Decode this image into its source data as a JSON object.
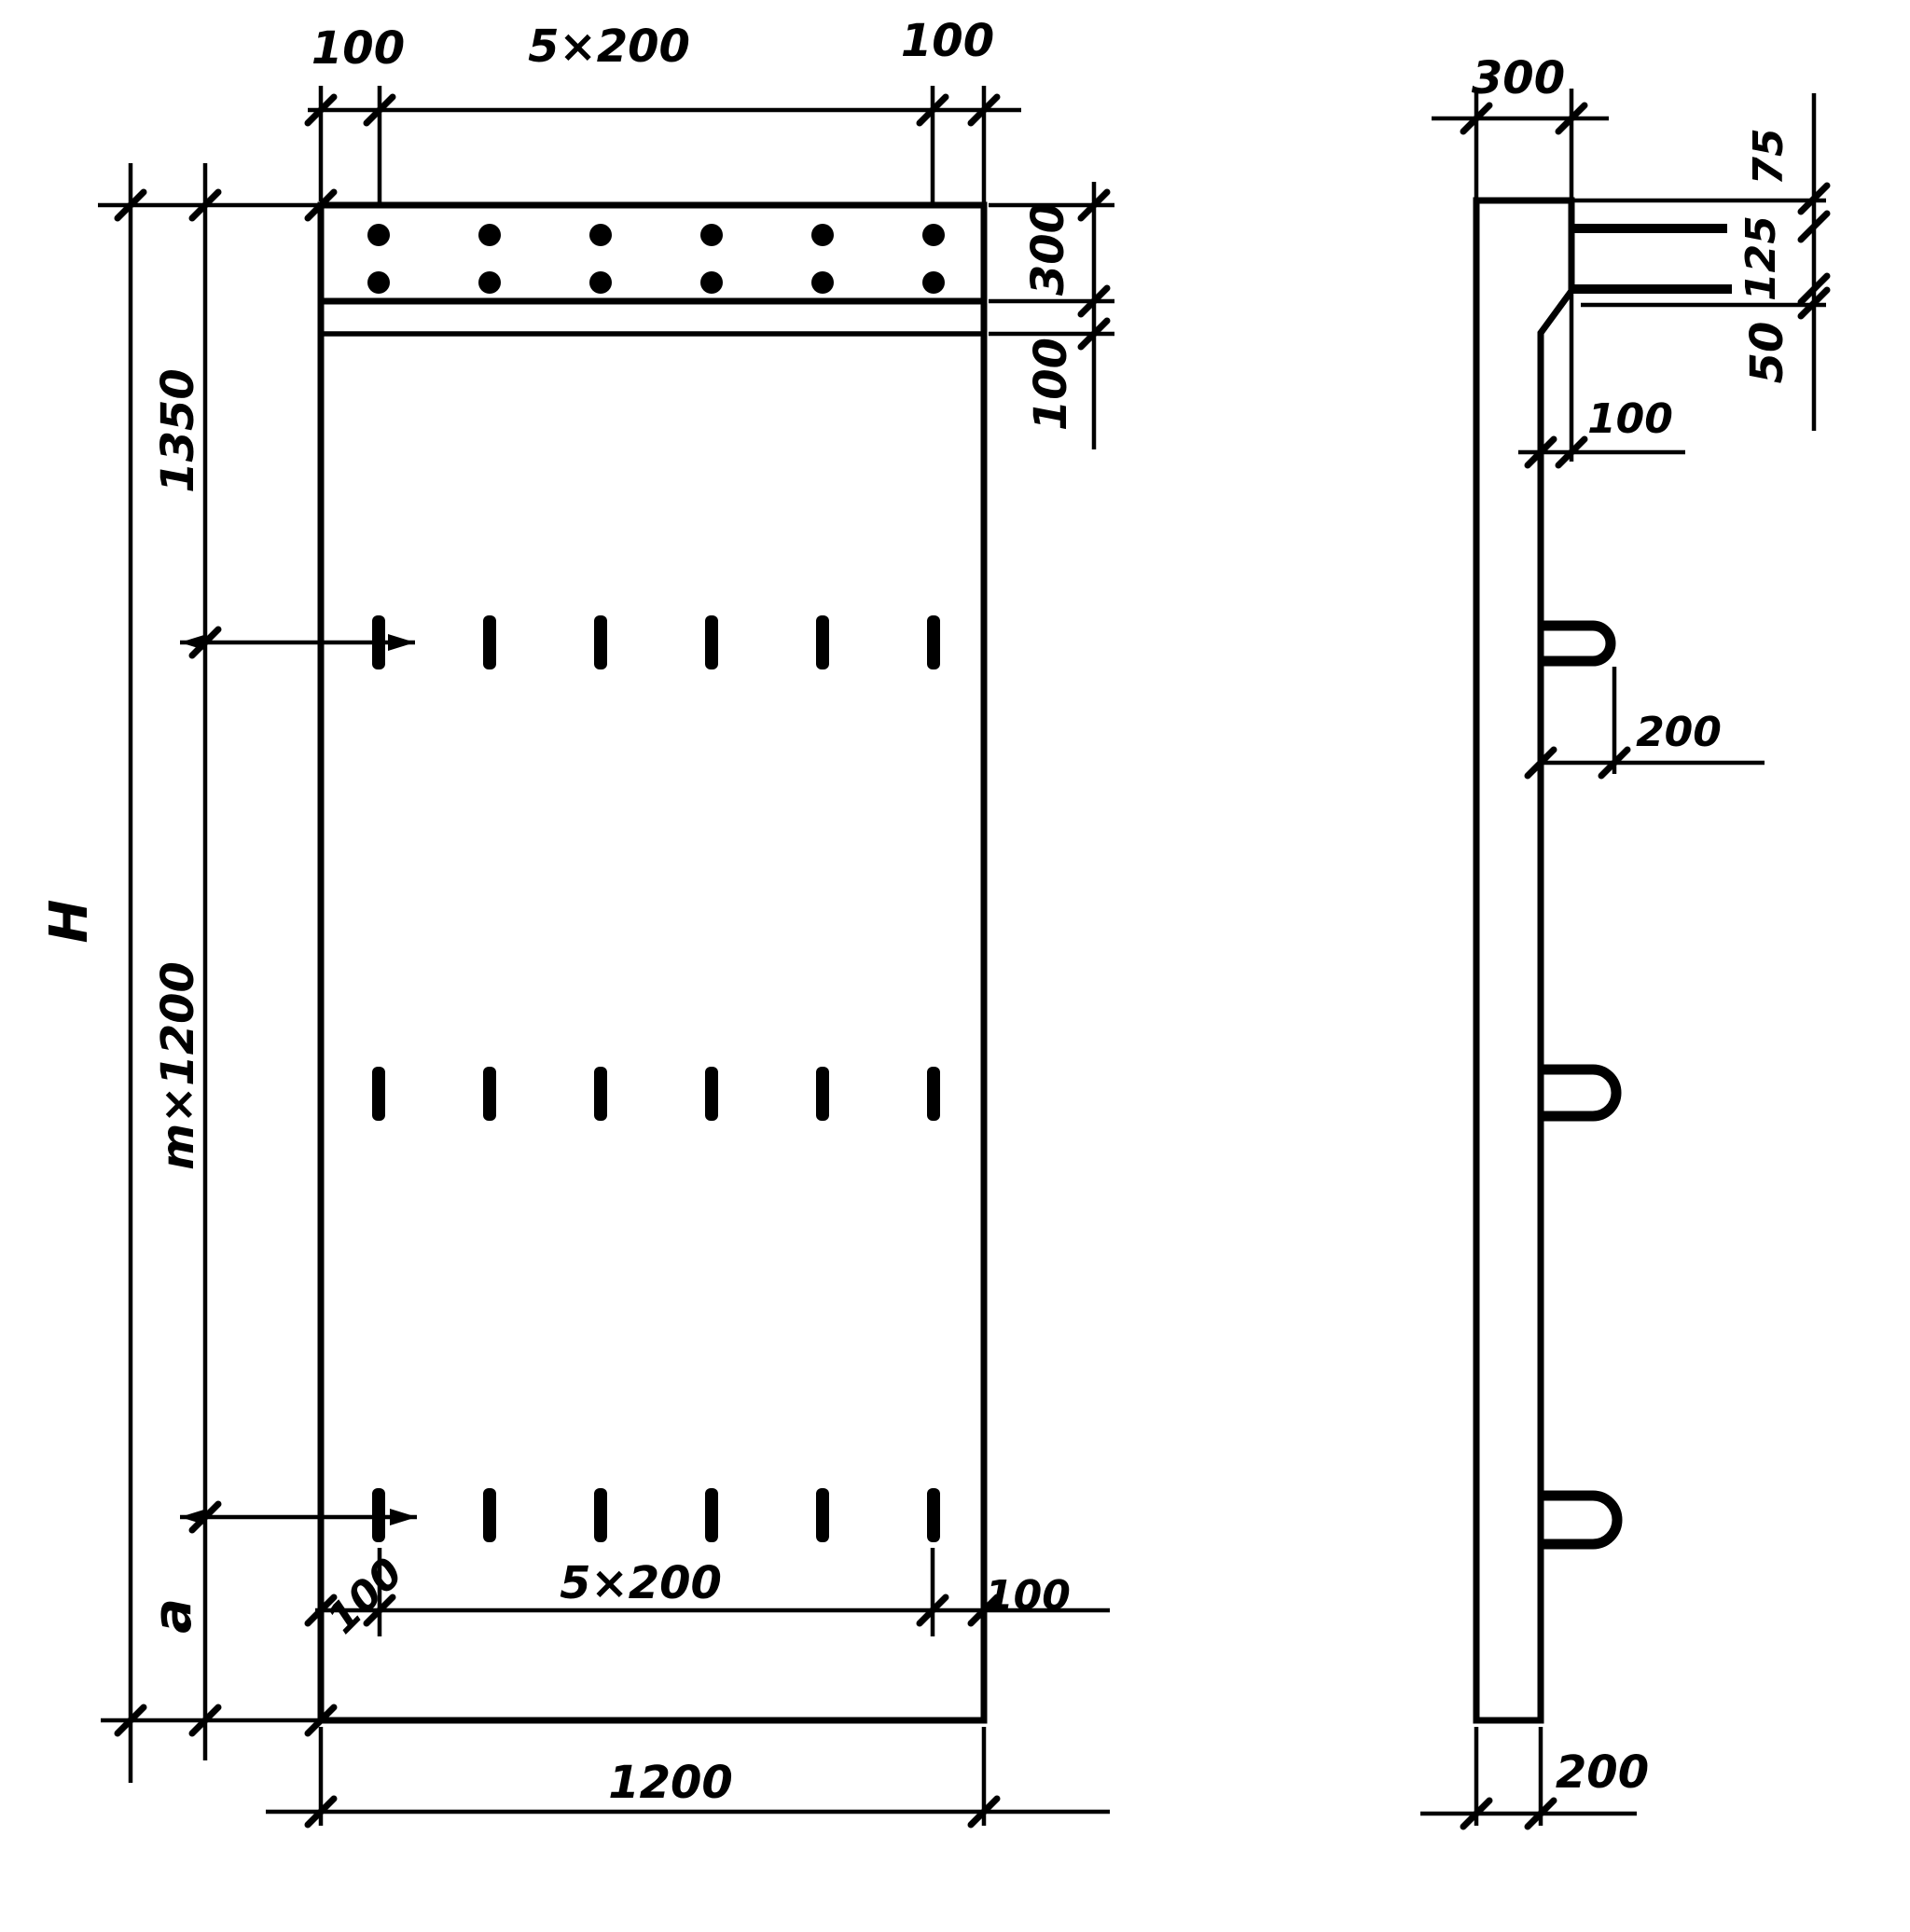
{
  "drawing": {
    "front_view": {
      "top_dims": {
        "left": "100",
        "center": "5×200",
        "right": "100"
      },
      "right_dims": {
        "band_height": "300",
        "below_band": "100"
      },
      "left_dims": {
        "top": "1350",
        "middle": "m×1200",
        "bottom": "a",
        "overall_height": "H"
      },
      "bottom_dims": {
        "left": "100",
        "center": "5×200",
        "right": "100"
      },
      "overall_width": "1200"
    },
    "side_view": {
      "top_width": "300",
      "right_dims": {
        "first": "75",
        "second": "125",
        "third": "50"
      },
      "step_offset": "100",
      "loop_projection": "200",
      "bottom_width": "200"
    }
  }
}
